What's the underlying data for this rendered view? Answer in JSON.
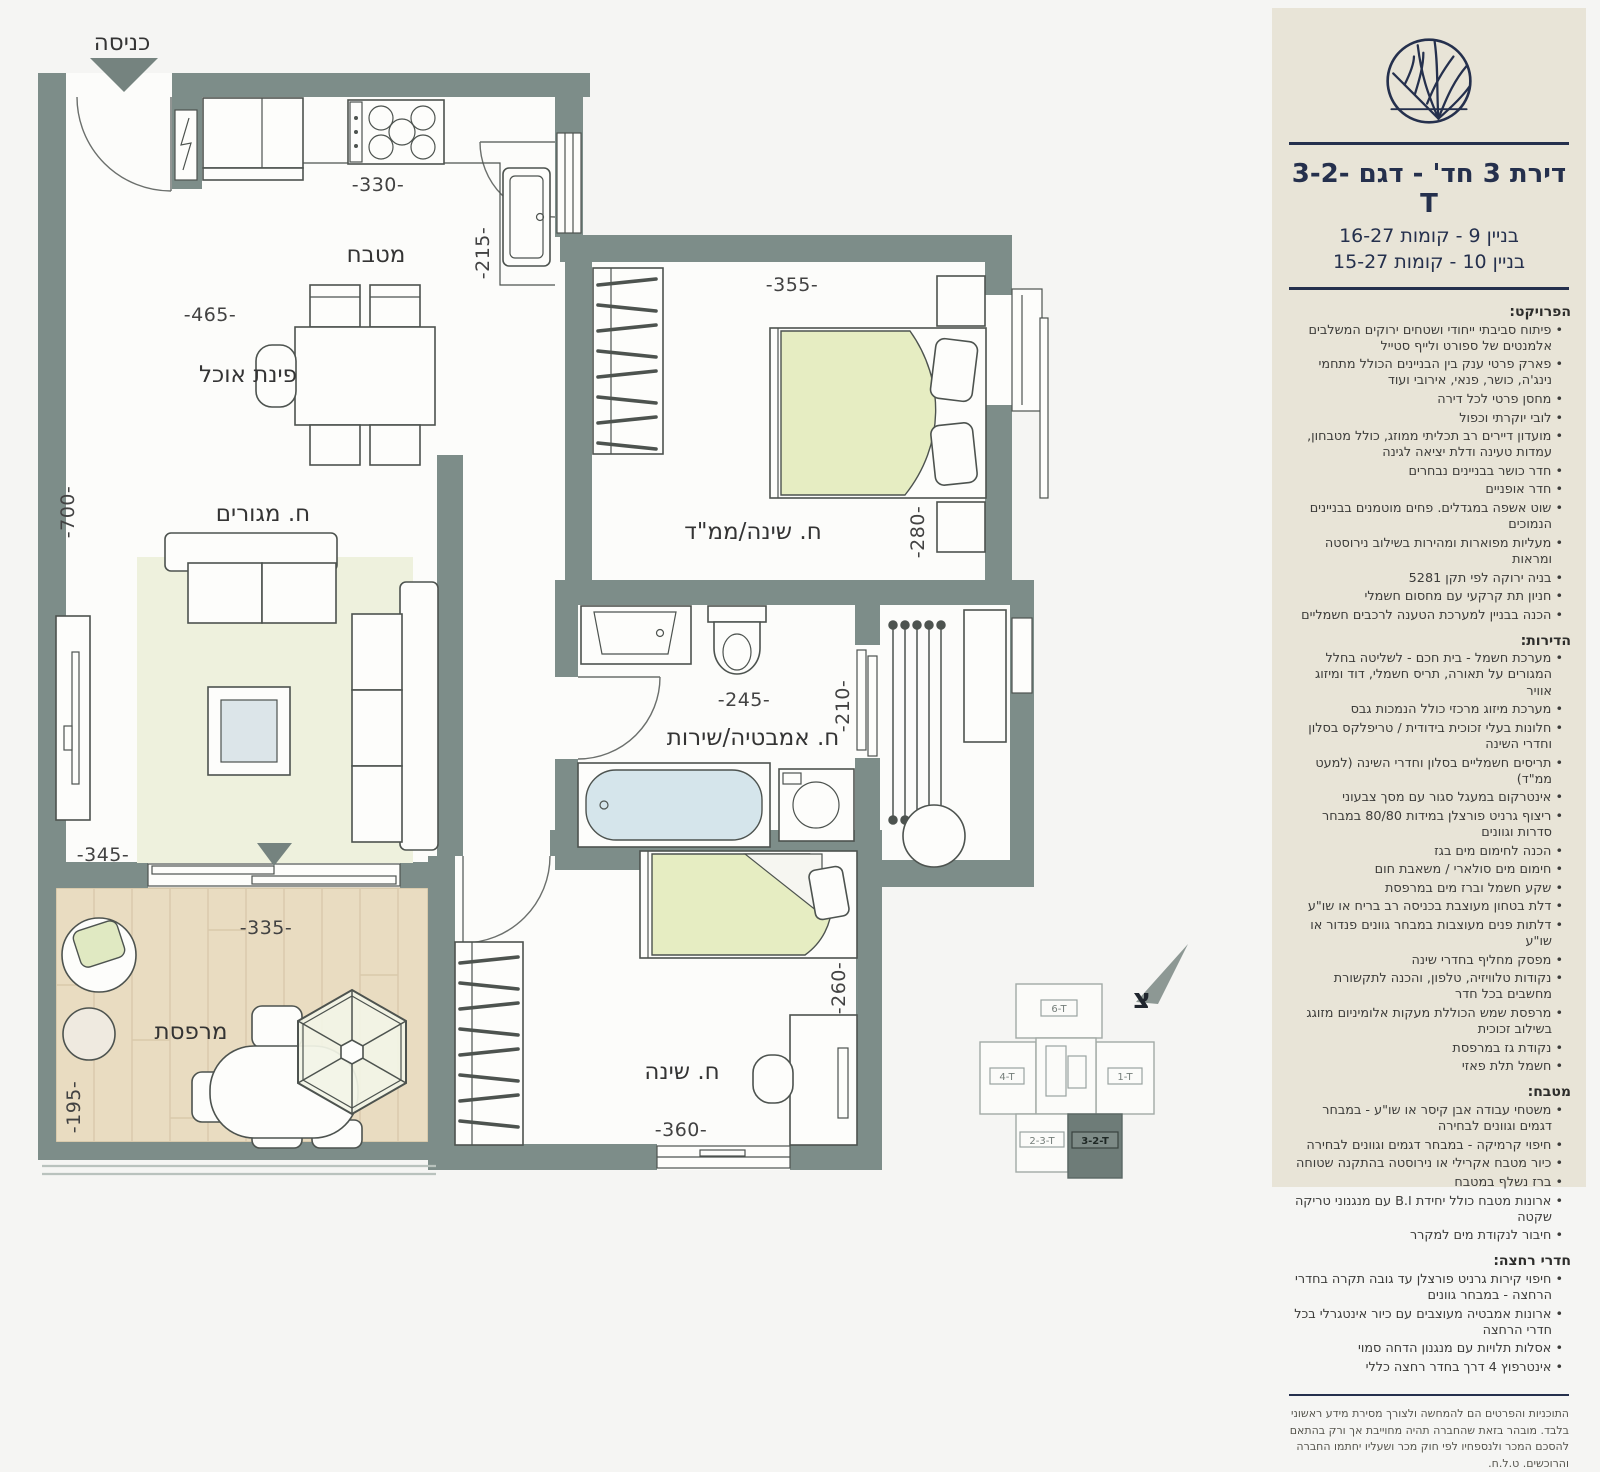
{
  "plan": {
    "entrance": "כניסה",
    "kitchen": {
      "label": "מטבח",
      "dim_top": "-330-",
      "dim_right": "-215-",
      "dim_width": "-465-"
    },
    "dining": {
      "label": "פינת אוכל"
    },
    "living": {
      "label": "ח. מגורים",
      "dim_height": "-700-",
      "dim_width": "-345-"
    },
    "master": {
      "label": "ח. שינה/ממ\"ד",
      "dim_top": "-355-",
      "dim_right": "-280-"
    },
    "bath": {
      "label": "ח. אמבטיה/שירות",
      "dim_width": "-245-",
      "dim_right": "-210-"
    },
    "bedroom2": {
      "label": "ח. שינה",
      "dim_bottom": "-360-",
      "dim_right": "-260-"
    },
    "balcony": {
      "label": "מרפסת",
      "dim_top": "-335-",
      "dim_left": "-195-"
    },
    "north": "צ",
    "keyplan": {
      "units": [
        "6-T",
        "4-T",
        "1-T",
        "2-3-T",
        "3-2-T"
      ],
      "highlighted_unit": "3-2-T"
    }
  },
  "sidebar": {
    "title_prefix": "דירת 3 חד' - דגם",
    "title_model": "3-2-T",
    "building_lines": [
      "בניין 9 - קומות 16-27",
      "בניין 10 - קומות 15-27"
    ],
    "sections": [
      {
        "heading": "הפרויקט:",
        "items": [
          "פיתוח סביבתי ייחודי ושטחים ירוקים המשלבים אלמנטים של ספורט ולייף סטייל",
          "פארק פרטי ענק בין הבניינים הכולל מתחמי נינג'ה, כושר, פנאי, אירובי ועוד",
          "מחסן פרטי לכל דירה",
          "לובי יוקרתי וכפול",
          "מועדון דיירים רב תכליתי ממוזג, כולל מטבחון, עמדות טעינה ודלת יציאה לגינה",
          "חדר כושר בבניינים נבחרים",
          "חדר אופניים",
          "שוט אשפה במגדלים. פחים מוטמנים בבניינים הנמוכים",
          "מעליות מפוארות ומהירות בשילוב נירוסטה ומראות",
          "בניה ירוקה לפי תקן 5281",
          "חניון תת קרקעי עם מחסום חשמלי",
          "הכנה בבניין למערכת הטענה לרכבים חשמליים"
        ]
      },
      {
        "heading": "הדירות:",
        "items": [
          "מערכת חשמל - בית חכם - לשליטה בחלל המגורים על תאורה, תריס חשמלי, דוד ומיזוג אוויר",
          "מערכת מיזוג מרכזי כולל הנמכות גבס",
          "חלונות בעלי זכוכית בידודית / טריפלקס בסלון וחדרי השינה",
          "תריסים חשמליים בסלון וחדרי השינה (למעט ממ\"ד)",
          "אינטרקום במעגל סגור עם מסך צבעוני",
          "ריצוף גרניט פורצלן במידות 80/80 במבחר סדרות וגוונים",
          "הכנה לחימום מים בגז",
          "חימום מים סולארי / משאבת חום",
          "שקע חשמל וברז מים במרפסת",
          "דלת בטחון מעוצבת בכניסה רב בריח או שו\"ע",
          "דלתות פנים מעוצבות במבחר גוונים פנדור או שו\"ע",
          "מפסק מחליף בחדרי שינה",
          "נקודות טלוויזיה, טלפון, והכנה לתקשורת מחשבים בכל חדר",
          "מרפסת שמש הכוללת מעקות אלומיניום מזוגג בשילוב זכוכית",
          "נקודת גז במרפסת",
          "חשמל תלת פאזי"
        ]
      },
      {
        "heading": "מטבח:",
        "items": [
          "משטחי עבודה אבן קיסר או שו\"ע - במבחר דגמים וגוונים לבחירה",
          "חיפוי קרמיקה - במבחר דגמים וגוונים לבחירה",
          "כיור מטבח אקרילי או נירוסטה בהתקנה שטוחה",
          "ברז נשלף במטבח",
          "ארונות מטבח כולל יחידת B.I עם מנגנוני טריקה שקטה",
          "חיבור לנקודת מים למקרר"
        ]
      },
      {
        "heading": "חדרי רחצה:",
        "items": [
          "חיפוי קירות גרניט פורצלן עד גובה תקרה בחדרי הרחצה - במבחר גוונים",
          "ארונות אמבטיה מעוצבים עם כיור אינטגרלי בכל חדרי הרחצה",
          "אסלות תלויות עם מנגנון הדחה סמוי",
          "אינטרפוץ 4 דרך בחדר רחצה כללי"
        ]
      }
    ],
    "disclaimer": "התוכניות והפרטים הם להמחשה ולצורך מסירת מידע ראשוני בלבד. מובהר בזאת שהחברה תהיה מחוייבת אך ורק בהתאם להסכם המכר ולנספחיו לפי חוק מכר ושעליו יחתמו החברה והרוכשים. ט.ל.ח."
  },
  "colors": {
    "wall": "#7d8d89",
    "panel_bg": "#e8e4d7",
    "navy": "#25304d",
    "green_textile": "#e6edc2",
    "wood": "#e9dcc1",
    "tub_blue": "#d5e5eb"
  }
}
